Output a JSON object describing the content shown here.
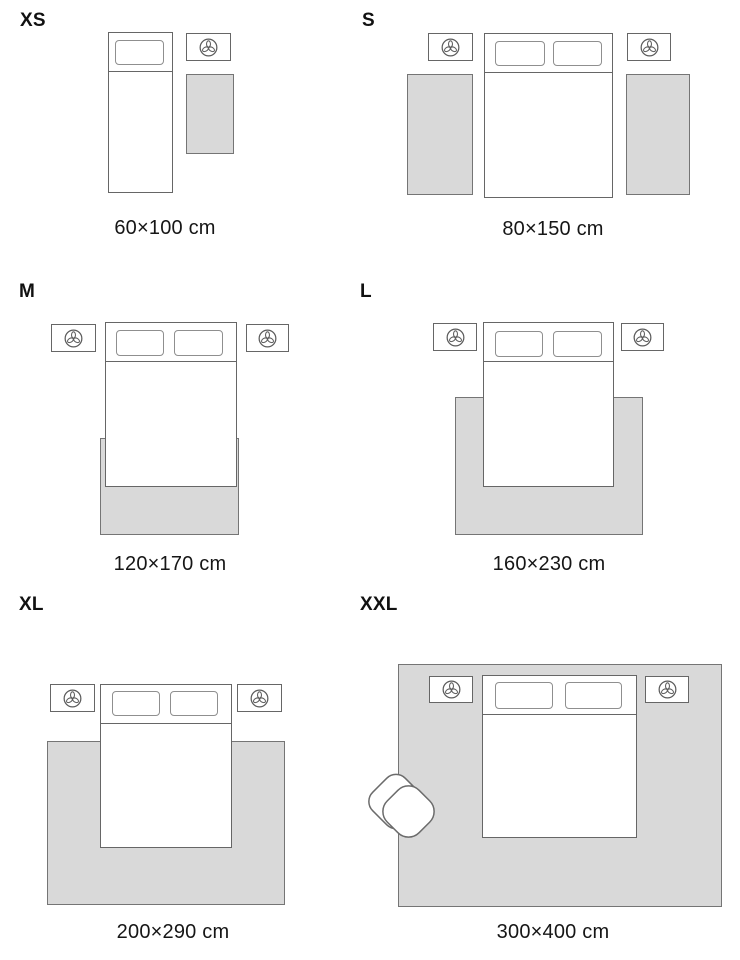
{
  "guide": {
    "unit": "cm",
    "sizes": [
      {
        "label": "XS",
        "dimensions": "60×100 cm"
      },
      {
        "label": "S",
        "dimensions": "80×150 cm"
      },
      {
        "label": "M",
        "dimensions": "120×170 cm"
      },
      {
        "label": "L",
        "dimensions": "160×230 cm"
      },
      {
        "label": "XL",
        "dimensions": "200×290 cm"
      },
      {
        "label": "XXL",
        "dimensions": "300×400 cm"
      }
    ]
  },
  "icons": {
    "nightstand_decor": "plant-icon",
    "xxl_seating": "armchair-icon"
  },
  "colors": {
    "background": "#ffffff",
    "rug_fill": "#d9d9d9",
    "rug_border": "#757575",
    "furniture_border": "#666666",
    "pillow_border": "#8f8f8f",
    "text": "#161616"
  }
}
